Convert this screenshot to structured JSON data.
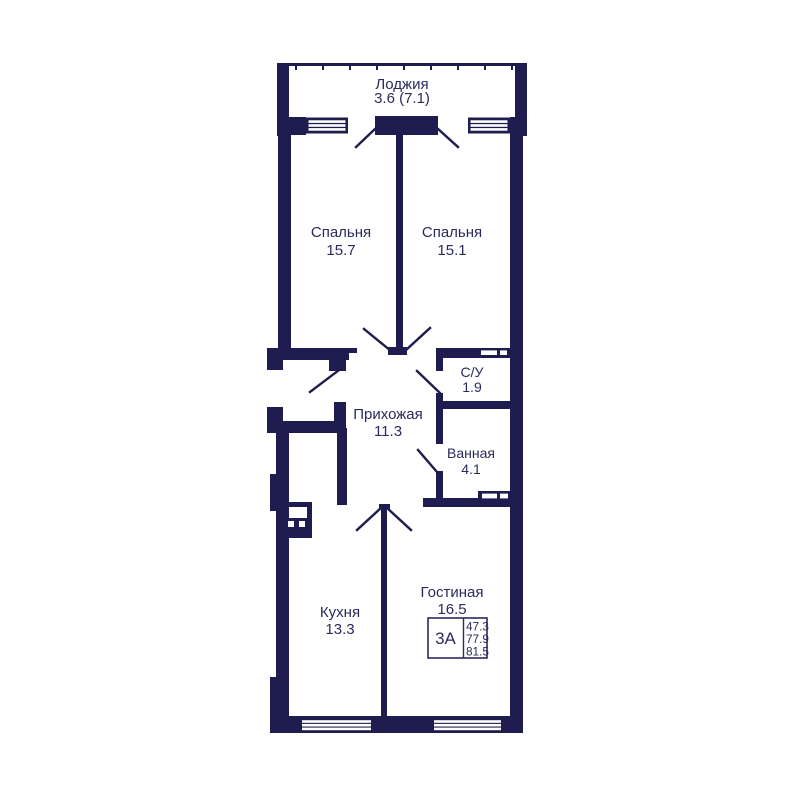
{
  "page": {
    "background": "#ffffff"
  },
  "plan": {
    "colors": {
      "wall": "#1f1d4f",
      "text": "#2b2a5e",
      "background": "#ffffff"
    },
    "loggia": {
      "name": "Лоджия",
      "area": "3.6 (7.1)"
    },
    "rooms": [
      {
        "key": "bedroom-1",
        "name": "Спальня",
        "area": "15.7"
      },
      {
        "key": "bedroom-2",
        "name": "Спальня",
        "area": "15.1"
      },
      {
        "key": "wc",
        "name": "С/У",
        "area": "1.9"
      },
      {
        "key": "hallway",
        "name": "Прихожая",
        "area": "11.3"
      },
      {
        "key": "bathroom",
        "name": "Ванная",
        "area": "4.1"
      },
      {
        "key": "kitchen",
        "name": "Кухня",
        "area": "13.3"
      },
      {
        "key": "living-room",
        "name": "Гостиная",
        "area": "16.5"
      }
    ],
    "unit_badge": {
      "label": "3А",
      "areas": [
        "47.3",
        "77.9",
        "81.5"
      ]
    }
  }
}
